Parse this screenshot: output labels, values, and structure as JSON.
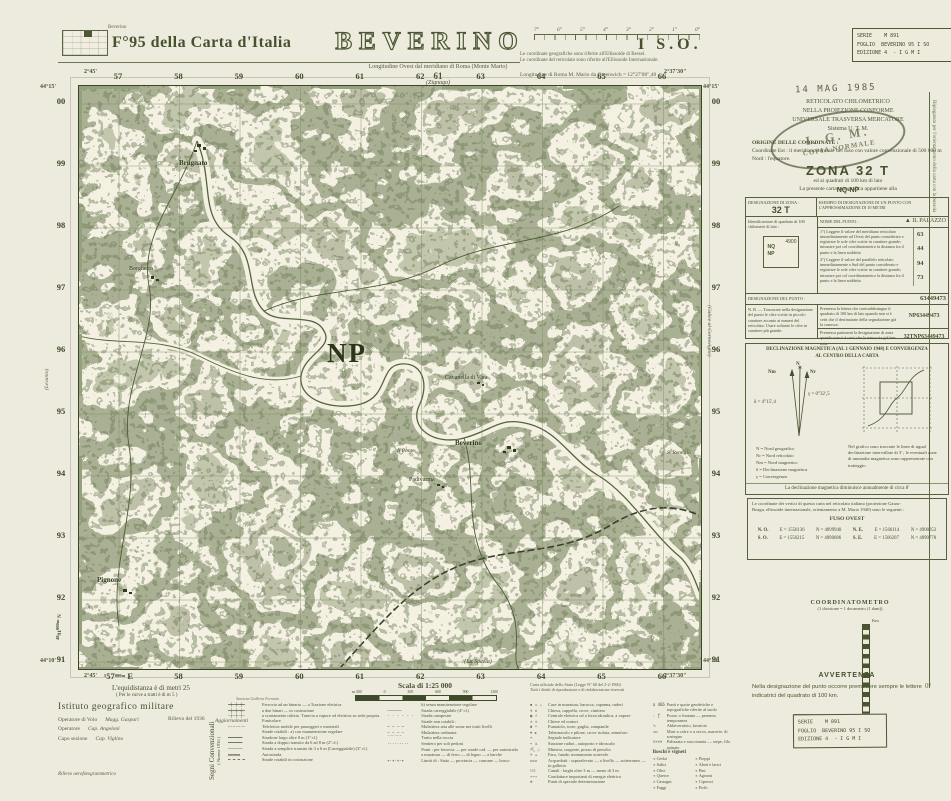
{
  "header": {
    "index_caption": "Beverino",
    "sheet": "F°95 della Carta d'Italia",
    "title": "BEVERINO",
    "lon_note": "Longitudine Ovest dal meridiano di Roma (Monte Mario)",
    "bessel1": "Le coordinate geografiche sono riferite all'Ellissoide di Bessel.",
    "bessel2": "Le coordinate del reticolato sono riferite all'Ellissoide Internazionale.",
    "greenwich": "Longitudine di Roma M. Mario da Greenwich = 12°27'08\",40",
    "quadrant": "I S.O.",
    "adj_top_num": "61",
    "adj_top_name": "(Zignago)",
    "protractor": [
      "7°",
      "6°",
      "5°",
      "4°",
      "3°",
      "2°",
      "1°",
      "0°"
    ]
  },
  "stamps": {
    "series_l1": "SERIE    M 891",
    "series_l2": "FOGLIO  BEVERINO 95 I SO",
    "series_l3": "EDIZIONE 4  - I G M I",
    "date": "14 MAG 1985",
    "oval_top": "I. G. M.",
    "oval_main": "COPIA NORMALE"
  },
  "map": {
    "grid_cols_top": [
      "57",
      "58",
      "59",
      "60",
      "61",
      "62",
      "63",
      "64",
      "65",
      "66"
    ],
    "grid_cols_bottom": [
      "",
      "58",
      "59",
      "60",
      "61",
      "62",
      "63",
      "64",
      "65",
      "66"
    ],
    "grid_rows": [
      "00",
      "99",
      "98",
      "97",
      "96",
      "95",
      "94",
      "93",
      "92",
      "91"
    ],
    "nw_lon": "2°45'",
    "nw_lat": "44°15'",
    "ne_lon": "2°37'30\"",
    "ne_lat": "44°15'",
    "sw_lon": "2°45'",
    "sw_lat": "44°10'",
    "se_lon": "2°37'30\"",
    "se_lat": "44°10'",
    "e_pre": "5",
    "e_num": "57",
    "e_suf": "000m",
    "e_unit": "E",
    "n_pre": "48",
    "n_num": "91",
    "n_suf": "000m",
    "n_unit": "N",
    "adj_left": "(Levanto)",
    "adj_right": "(Calice al Cornoviglio)",
    "adj_bottom": "(La Spezia)",
    "square": "NP",
    "labels": [
      "Brugnato",
      "Borghetto",
      "Cavanella di Vara",
      "Beverino",
      "Padivarma",
      "Il Ponte",
      "S. Remigio",
      "Pignone"
    ]
  },
  "sidebar": {
    "utm": [
      "RETICOLATO CHILOMETRICO",
      "NELLA PROIEZIONE CONFORME",
      "UNIVERSALE TRASVERSA MERCATORE",
      "Sistema U. T. M."
    ],
    "origin_title": "ORIGINE DELLE COORDINATE :",
    "origin": [
      "Coordinate Est : il meridiano centrale del fuso con valore convenzionale di 500 000 m",
      "Nord : l'equatore."
    ],
    "appartiene": "La presente carta topografica appartiene alla",
    "zona": "ZONA  32 T",
    "quadrati": "ed ai quadrati di 100 km di lato",
    "nqnp": "NQ-NP",
    "table": {
      "dz": "DESIGNAZIONE DI ZONA :",
      "dz_val": "32 T",
      "esempio": "ESEMPIO DI DESIGNAZIONE DI UN PUNTO CON L'APPROSSIMAZIONE DI 10 METRI",
      "ident": "Identificazione di quadrato di 100 chilometri di lato :",
      "diag_nq": "NQ",
      "diag_np": "NP",
      "diag_val": "4900",
      "nome": "NOME DEL PUNTO :",
      "nome_val": "▲ IL PALAZZO",
      "istr1": "1°) Leggere il valore del meridiano reticolato immediatamente ad Ovest del punto considerato e registrare le sole cifre scritte in carattere grande; misurare poi col coordinatometro la distanza fra il punto e la linea suddetta",
      "n1": "63",
      "n2": "44",
      "istr2": "2°) Leggere il valore del parallelo reticolato immediatamente a Sud del punto considerato e registrare le sole cifre scritte in carattere grande; misurare poi col coordinatometro la distanza fra il punto e la linea suddetta",
      "n3": "94",
      "n4": "73",
      "desig": "DESIGNAZIONE DEL PUNTO :",
      "desig_val": "63449473",
      "nb": "N. B. — Trascurare nella designazione del punto le cifre scritte in piccolo carattere accanto ai numeri del reticolato. Usare soltanto le cifre in carattere più grande.",
      "p1": "Premessa la lettera che contraddistingue il quadrato di 100 km di lato quando non si è certi che il destinatario della segnalazione già la conosca:",
      "p1_val": "NP63449473",
      "p2": "Premessa parimenti la designazione di zona quando non si è certi che la stessa sia già ben nota:",
      "p2_val": "32TNP63449473"
    },
    "decl": {
      "t1": "DECLINAZIONE MAGNETICA (AL 1 GENNAIO 1948) E CONVERGENZA",
      "t2": "AL CENTRO DELLA CARTA",
      "nlab": "N",
      "nrlab": "Nr",
      "nmlab": "Nm",
      "delta": "δ = 4°15',4",
      "gamma": "γ = 0°32',5",
      "leg": [
        "N   =  Nord geografico",
        "Nr  =  Nord reticolato",
        "Nm =  Nord magnetico",
        "δ   =  Declinazione magnetica",
        "γ   =  Convergenza"
      ],
      "note": "Nel grafico sono tracciate le linee di ugual declinazione intervallate di 3' ; le eventuali zone di anomalia magnetica sono rappresentate con tratteggio.",
      "annua": "La declinazione magnetica diminuisce annualmente di circa 8'"
    },
    "vert": {
      "i1": "Le coordinate dei vertici di questa carta nel reticolato italiano (proiezione Gauss-",
      "i2": "Boaga, ellissoide internazionale, orientamento a M. Mario 1940) sono le seguenti :",
      "fuso": "FUSO OVEST",
      "rows": [
        {
          "c": "N. O.",
          "e": "E = 1556136",
          "n": "N = 4899940"
        },
        {
          "c": "N. E.",
          "e": "E = 1566114",
          "n": "N = 4900053"
        },
        {
          "c": "S. O.",
          "e": "E = 1556215",
          "n": "N = 4890686"
        },
        {
          "c": "S. E.",
          "e": "E = 1566207",
          "n": "N = 4890778"
        }
      ]
    },
    "coordmetro_t": "COORDINATOMETRO",
    "coordmetro_s": "(1 divisione = 1 decametro (1 dam))",
    "coordmetro_km": "Km",
    "avv_t": "AVVERTENZA",
    "avv_p": "Nella designazione del punto occorre premettere sempre le lettere indicatrici del quadrato di 100 km.",
    "margin": "Ripiegatura per l'orientamento della carta con la bussola",
    "margin_deg": "0°"
  },
  "footer": {
    "equi1": "L'equidistanza è di metri 25",
    "equi2": "( Per le curve a tratti è di m 5 )",
    "istituto": "Istituto geografico militare",
    "staff": [
      {
        "r": "Operatore di Volo",
        "n": "Magg. Gaspari"
      },
      {
        "r": "Operatore",
        "n": "Cap. Angeloni"
      },
      {
        "r": "Capo sezione",
        "n": "Cap. Viglino"
      }
    ],
    "rilievo": "Rilievo del 1936",
    "agg": "Aggiornamenti",
    "aero": "Rilievo aerofotogrammetrico",
    "segni1": "Segni Convenzionali",
    "segni2": "( Norme 1936 )",
    "scala": "Scala di 1:25 000",
    "scale_ticks": [
      "m.300",
      "0",
      "300",
      "600",
      "900",
      "1200"
    ],
    "col_a_head": "Stazione        Galleria        Fermata",
    "col_a": [
      {
        "sym": "━┿━┿━┿━",
        "label": "Ferrovia ad un binario — a Trazione elettrica"
      },
      {
        "sym": "━╪━╪━╪━",
        "label": "a due binari — in costruzione"
      },
      {
        "sym": "┄┼┄┼┄┼┄",
        "label": "a scartamento ridotto. Tranvia a vapore od elettrica su sede propria. Funicolare"
      },
      {
        "sym": "─·─·─·─",
        "label": "Teleferica mobile per passeggeri e materiali"
      },
      {
        "sym": "",
        "label": "Strade rotabili :  a) con manutenzione regolare"
      },
      {
        "sym": "══════",
        "label": "Stradone largo oltre 8 m   (1ª cl.)"
      },
      {
        "sym": "══════",
        "label": "Strada a doppio transito da 6 ad 8 m   (2ª cl.)"
      },
      {
        "sym": "──────",
        "label": "Strada a semplice transito da 3 a 6 m (Carreggiabile)  (3ª cl.)"
      },
      {
        "sym": "▬▬▬▬▬",
        "label": "Autostrada"
      },
      {
        "sym": "═ ═ ═ ═",
        "label": "Strade rotabili in costruzione"
      }
    ],
    "col_b": [
      {
        "sym": "",
        "label": "b) senza manutenzione regolare"
      },
      {
        "sym": "──────",
        "label": "Strada carreggiabile   (4ª cl.)"
      },
      {
        "sym": "- - - - - -",
        "label": "Strada campestre"
      },
      {
        "sym": "",
        "label": "Strade non rotabili :"
      },
      {
        "sym": "─ ─ ─ ─",
        "label": "Mulattiera atta alle some nei tratti livelli"
      },
      {
        "sym": "– – – –",
        "label": "Mulattiera ordinaria"
      },
      {
        "sym": "¨¨¨¨¨¨",
        "label": "Tratto nella roccia"
      },
      {
        "sym": "·········",
        "label": "Sentiero per soli pedoni"
      },
      {
        "sym": "",
        "label": "Ponti :  per ferrovia — per strade ord. — per autostrada"
      },
      {
        "sym": "",
        "label": "a muratura — di ferro — di legno — a barche"
      },
      {
        "sym": "+·+·+·+",
        "label": "Limiti di :  Stato — provincia — comune — bosco"
      }
    ],
    "col_c": [
      {
        "sym": "▪ ▫ ▵",
        "label": "Case in muratura, baracca, capanna, ruderi"
      },
      {
        "sym": "✝ ⌂",
        "label": "Chiesa, cappella, croce, cimitero"
      },
      {
        "sym": "◉ ⚡",
        "label": "Centrale elettrica od a forza idraulica, a vapore"
      },
      {
        "sym": "✛ ✛",
        "label": "Chiese ed oratori"
      },
      {
        "sym": "▮ ◠",
        "label": "Fumaiolo, torre, guglia, campanile"
      },
      {
        "sym": "⌖ ✚",
        "label": "Tabernacolo e pilone, croce isolata, semaforo"
      },
      {
        "sym": "→",
        "label": "Segnale indicatore"
      },
      {
        "sym": "⌔ ⚓",
        "label": "Stazione radiot., autoporto e idroscalo"
      },
      {
        "sym": "⛏ ◌",
        "label": "Miniera, sorgente, pozzo di petrolio"
      },
      {
        "sym": "☀ ▴",
        "label": "Faro, fanale, monumento notevole"
      },
      {
        "sym": "≍≍≍",
        "label": "Acquedotti :  sopraelevato — a livello — sotterraneo — in galleria"
      },
      {
        "sym": "⌇⌇⌇",
        "label": "Canali :  larghi oltre 3 m — meno di 3 m"
      },
      {
        "sym": "⌁⌁⌁",
        "label": "Condutture importanti di energia elettrica"
      },
      {
        "sym": "⊕",
        "label": "Punti di speciale determinazione"
      }
    ],
    "col_d": [
      {
        "sym": "a 466",
        "label": "Punti e quote geodetiche e topografiche riferite al suolo"
      },
      {
        "sym": "◦ ƒ",
        "label": "Pozzo o fontana — perenne, temporanea"
      },
      {
        "sym": "∿",
        "label": "Abbeveratoio, lavatoio"
      },
      {
        "sym": "▭▭",
        "label": "Muri a calce o a secco, macerie, di sostegno"
      },
      {
        "sym": "××××",
        "label": "Palizzata e staccionata — siepe, filo spinato"
      }
    ],
    "copyright1": "Carta ufficiale dello Stato (Legge N° 68 del 2-2-1960)",
    "copyright2": "Tutti i diritti di riproduzione e di rielaborazione riservati",
    "boschi_title": "Boschi e vigneti",
    "boschi": [
      "Cedui",
      "Salici",
      "Olivi",
      "Querce",
      "Castagni",
      "Faggi",
      "Pioppi",
      "Abeti e larici",
      "Pini",
      "Agrumi",
      "Cipressi",
      "Fichi"
    ]
  },
  "colors": {
    "paper": "#edeade",
    "map_paper": "#f4f1e2",
    "ink": "#46512e",
    "terrain": "#55633c"
  }
}
